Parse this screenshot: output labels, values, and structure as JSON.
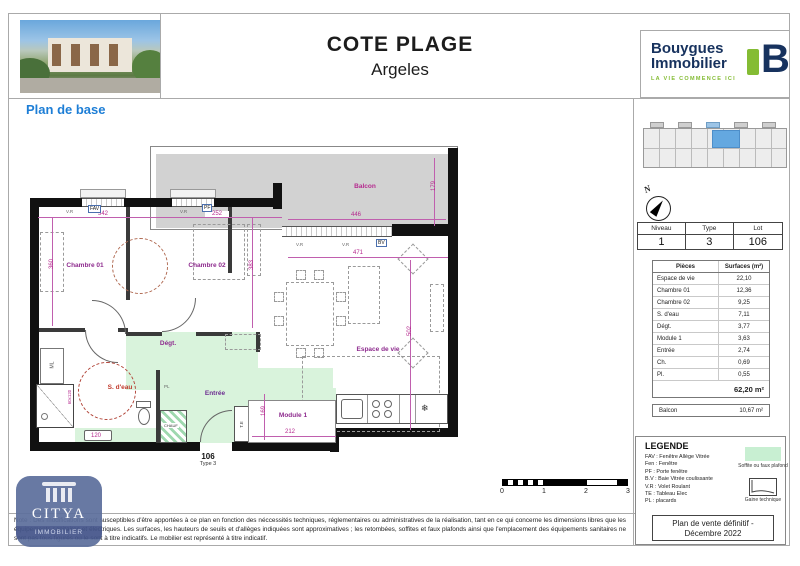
{
  "header": {
    "title1": "COTE PLAGE",
    "title2": "Argeles",
    "brand1": "Bouygues",
    "brand2": "Immobilier",
    "tagline": "LA VIE COMMENCE ICI",
    "bmark": "B"
  },
  "section_title": "Plan de base",
  "plan": {
    "balcon": "Balcon",
    "rooms": {
      "chambre01": "Chambre 01",
      "chambre02": "Chambre 02",
      "degt": "Dégt.",
      "sdeau": "S. d'eau",
      "entree": "Entrée",
      "module1": "Module 1",
      "espace_de_vie": "Espace de vie"
    },
    "dims": {
      "d342": "342",
      "d252": "252",
      "d446": "446",
      "d179": "179",
      "d471": "471",
      "d502": "502",
      "d360": "360",
      "d383": "383",
      "d169": "169",
      "d212": "212",
      "d120": "120",
      "d60x120": "60x120"
    },
    "tags": {
      "fav": "FAV",
      "pf": "PF",
      "bv": "BV",
      "vr": "V.R",
      "pl": "PL",
      "te": "T.E",
      "ml": "ML",
      "chauf": "CHAUF"
    },
    "lot": {
      "number": "106",
      "type": "Type 3"
    },
    "fridge_icon": "❄"
  },
  "sidebar": {
    "compass_n": "N",
    "unit_table": {
      "headers": [
        "Niveau",
        "Type",
        "Lot"
      ],
      "values": [
        "1",
        "3",
        "106"
      ]
    },
    "surfaces": {
      "col1": "Pièces",
      "col2": "Surfaces (m²)",
      "rows": [
        [
          "Espace de vie",
          "22,10"
        ],
        [
          "Chambre 01",
          "12,36"
        ],
        [
          "Chambre 02",
          "9,25"
        ],
        [
          "S. d'eau",
          "7,11"
        ],
        [
          "Dégt.",
          "3,77"
        ],
        [
          "Module 1",
          "3,63"
        ],
        [
          "Entrée",
          "2,74"
        ],
        [
          "Ch.",
          "0,69"
        ],
        [
          "Pl.",
          "0,55"
        ]
      ],
      "total": "62,20 m²"
    },
    "balcon": {
      "label": "Balcon",
      "value": "10,67 m²"
    }
  },
  "legend": {
    "title": "LEGENDE",
    "items": [
      "FAV : Fenêtre Allège Vitrée",
      "Fen : Fenêtre",
      "PF : Porte fenêtre",
      "B.V : Baie Vitrée coulissante",
      "V.R : Volet Roulant",
      "TE : Tableau Elec",
      "PL : placards"
    ],
    "soffite": "Soffite ou faux plafond",
    "gaine": "Gaine technique"
  },
  "footer": {
    "note": "Note : Des modifications sont susceptibles d'être apportées à ce plan en fonction des néccessités techniques, réglementaires ou administratives de la réalisation, tant en ce qui concerne les dimensions libres que les équipements sanitaires et électriques. Les surfaces, les hauteurs de seuils et d'allèges indiquées sont approximatives ; les retombées, soffites et faux plafonds ainsi que l'emplacement des équipements sanitaires ne sont pas tous figurés ou le sont à titre indicatifs. Le mobilier est représenté à titre indicatif.",
    "stamp1": "Plan de vente définitif -",
    "stamp2": "Décembre 2022"
  },
  "scalebar": {
    "ticks": [
      "0",
      "1",
      "2",
      "3"
    ]
  },
  "watermark": {
    "name": "CITYA",
    "subtitle": "IMMOBILIER"
  },
  "colors": {
    "accent_blue": "#1d7ed6",
    "brand_navy": "#17325e",
    "brand_green": "#84bc34",
    "plan_green": "#d9f3dc",
    "balcony_gray": "#d2d2d2",
    "dim_magenta": "#b5298e",
    "room_purple": "#8e2b8e"
  }
}
